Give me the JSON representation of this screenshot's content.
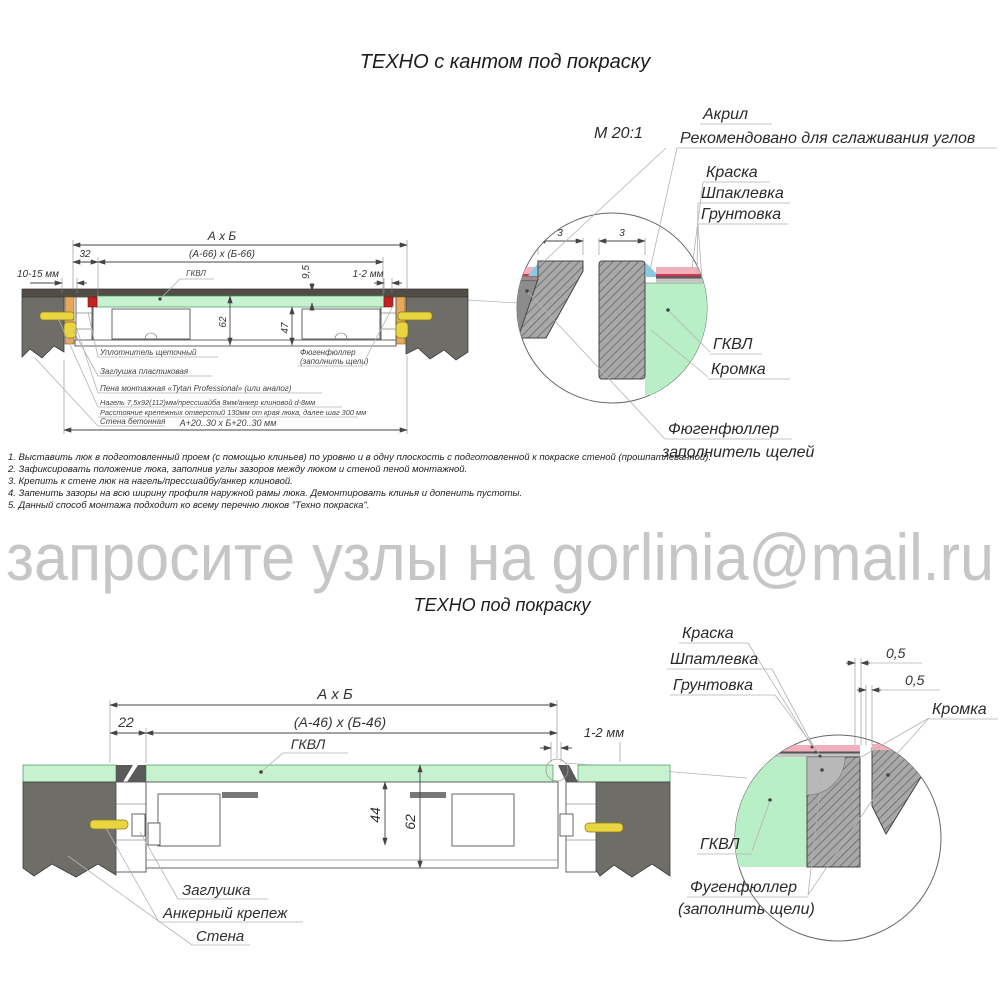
{
  "watermark": "запросите узлы на gorlinia@mail.ru",
  "top": {
    "title": "ТЕХНО с кантом под покраску",
    "scale": "М 20:1",
    "dims": {
      "overall": "А х Б",
      "leaf": "(А-66) х (Б-66)",
      "frame_offset": "32",
      "wall_clearance": "10-15 мм",
      "panel": "ГКВЛ",
      "panel_thk": "9,5",
      "gap": "1-2 мм",
      "depth": "62",
      "leaf_depth": "47",
      "opening": "А+20..30 х Б+20..30 мм"
    },
    "callouts": {
      "seal": "Уплотнитель щеточный",
      "plug": "Заглушка пластиковая",
      "foam": "Пена монтажная «Tytan Professional» (или аналог)",
      "fastener": "Нагель 7,5х92(112)мм/прессшайба 8мм/анкер клиновой d-8мм",
      "fastener2": "Расстояние крепежных отверстий 130мм от края люка, далее шаг 300 мм",
      "wall": "Стена бетонная",
      "filler1": "Фюгенфюллер",
      "filler2": "(заполнить щели)"
    },
    "detail": {
      "acrylic": "Акрил",
      "acrylic_note": "Рекомендовано для сглаживания углов",
      "paint": "Краска",
      "putty": "Шпаклевка",
      "primer": "Грунтовка",
      "board": "ГКВЛ",
      "edge": "Кромка",
      "filler1": "Фюгенфюллер",
      "filler2": "заполнитель щелей",
      "gap1": "3",
      "gap2": "3"
    }
  },
  "notes": [
    "1. Выставить люк в подготовленный проем (с помощью клиньев) по уровню и в одну плоскость с подготовленной к покраске стеной (прошпатлеванной).",
    "2. Зафиксировать положение люка, заполнив углы зазоров между люком и стеной пеной монтажной.",
    "3. Крепить к стене люк на нагель/прессшайбу/анкер клиновой.",
    "4. Запенить зазоры на всю ширину профиля наружной рамы люка. Демонтировать клинья и допенить пустоты.",
    "5. Данный способ монтажа подходит ко всему перечню люков \"Техно покраска\"."
  ],
  "bottom": {
    "title": "ТЕХНО под покраску",
    "dims": {
      "overall": "А х Б",
      "leaf": "(А-46) х (Б-46)",
      "frame_offset": "22",
      "gap": "1-2 мм",
      "panel": "ГКВЛ",
      "leaf_depth": "44",
      "depth": "62"
    },
    "callouts": {
      "plug": "Заглушка",
      "anchor": "Анкерный крепеж",
      "wall": "Стена"
    },
    "detail": {
      "paint": "Краска",
      "putty": "Шпатлевка",
      "primer": "Грунтовка",
      "gap1": "0,5",
      "gap2": "0,5",
      "edge": "Кромка",
      "board": "ГКВЛ",
      "filler1": "Фугенфюллер",
      "filler2": "(заполнить щели)"
    }
  },
  "colors": {
    "board_green": "#c6f2cf",
    "wall_gray": "#6f6d68",
    "wood_orange": "#e8a85a",
    "anchor_yellow": "#e9d53f",
    "seal_red": "#c42323",
    "paint_pink": "#f2b0bd",
    "acrylic_blue": "#85cbe8",
    "watermark_gray": "#c6c6c6"
  }
}
